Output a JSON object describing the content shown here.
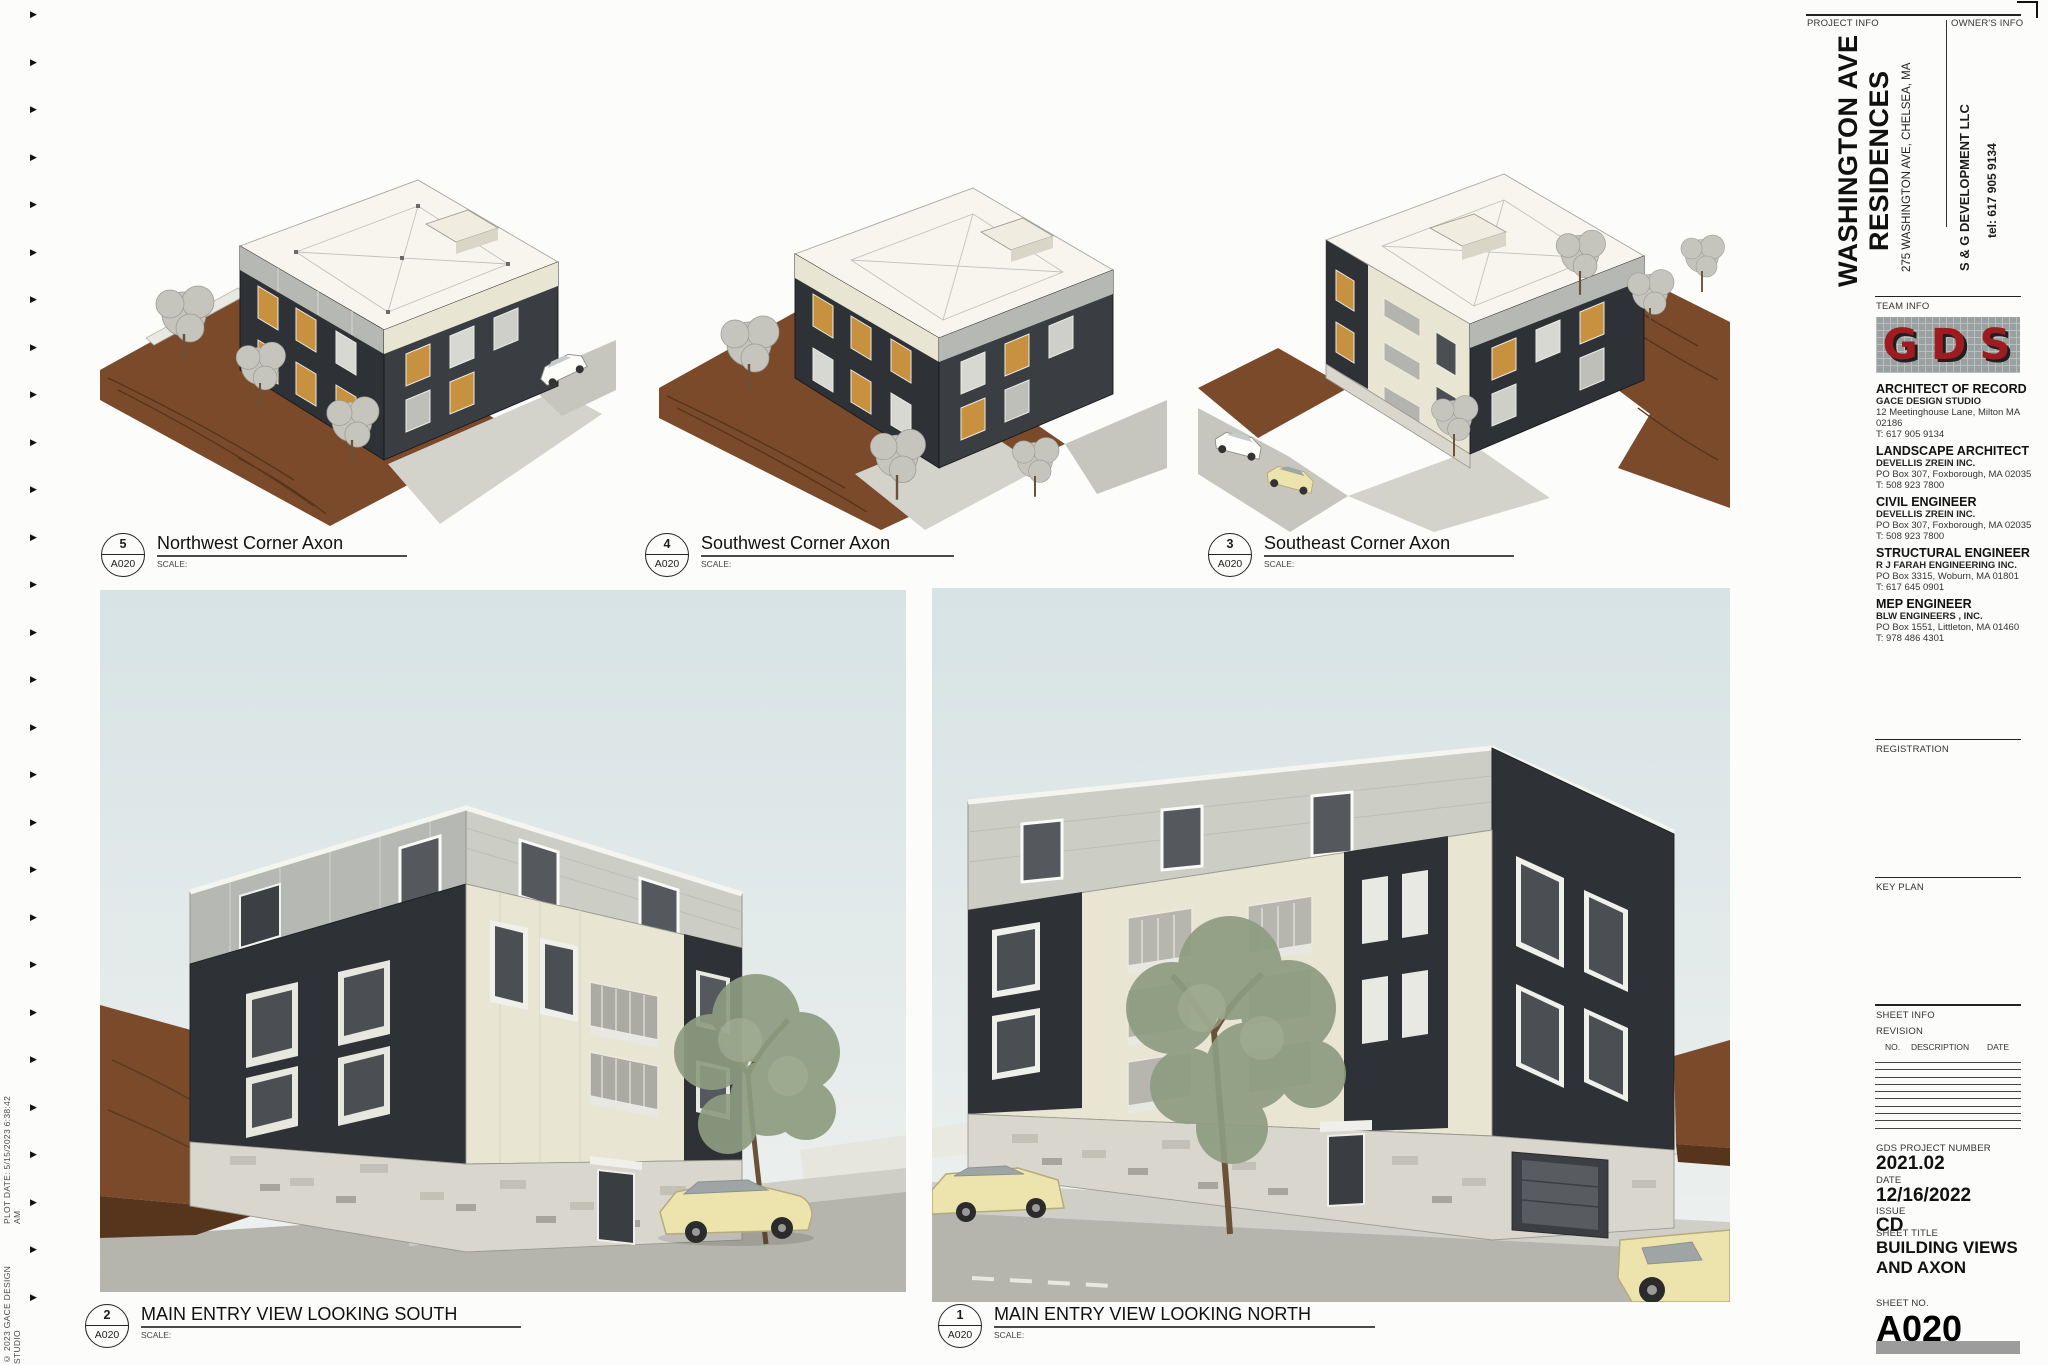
{
  "sheet_headers": {
    "project_info": "PROJECT INFO",
    "owners_info": "OWNER'S INFO",
    "team_info": "TEAM INFO",
    "registration": "REGISTRATION",
    "key_plan": "KEY PLAN",
    "sheet_info": "SHEET INFO",
    "revision": "REVISION",
    "rev_no": "NO.",
    "rev_description": "DESCRIPTION",
    "rev_date": "DATE"
  },
  "project": {
    "title_line1": "WASHINGTON AVE",
    "title_line2": "RESIDENCES",
    "address": "275 WASHINGTON AVE, CHELSEA, MA"
  },
  "owner": {
    "name": "S & G DEVELOPMENT LLC",
    "tel": "tel: 617 905 9134"
  },
  "logo": {
    "text": "GDS"
  },
  "team": [
    {
      "role": "ARCHITECT OF RECORD",
      "firm": "GACE DESIGN STUDIO",
      "address": "12 Meetinghouse Lane, Milton MA 02186",
      "tel": "T: 617 905 9134"
    },
    {
      "role": "LANDSCAPE ARCHITECT",
      "firm": "DEVELLIS ZREIN INC.",
      "address": "PO Box 307, Foxborough, MA 02035",
      "tel": "T: 508 923 7800"
    },
    {
      "role": "CIVIL ENGINEER",
      "firm": "DEVELLIS ZREIN INC.",
      "address": "PO Box 307, Foxborough, MA 02035",
      "tel": "T: 508 923 7800"
    },
    {
      "role": "STRUCTURAL ENGINEER",
      "firm": "R J FARAH ENGINEERING INC.",
      "address": "PO Box 3315, Woburn, MA 01801",
      "tel": "T: 617 645 0901"
    },
    {
      "role": "MEP ENGINEER",
      "firm": "BLW ENGINEERS , INC.",
      "address": "PO Box 1551, Littleton, MA 01460",
      "tel": "T: 978 486 4301"
    }
  ],
  "meta": {
    "project_number_label": "GDS PROJECT NUMBER",
    "project_number": "2021.02",
    "date_label": "DATE",
    "date": "12/16/2022",
    "issue_label": "ISSUE",
    "issue": "CD",
    "sheet_title_label": "SHEET TITLE",
    "sheet_title": "BUILDING VIEWS AND AXON",
    "sheet_no_label": "SHEET NO.",
    "sheet_no": "A020"
  },
  "edge": {
    "copyright": "© 2023 GACE DESIGN STUDIO",
    "plot_date": "PLOT DATE: 5/15/2023 6:38:42 AM"
  },
  "views": [
    {
      "num": "5",
      "ref": "A020",
      "title": "Northwest Corner Axon",
      "scale_label": "SCALE:"
    },
    {
      "num": "4",
      "ref": "A020",
      "title": "Southwest Corner Axon",
      "scale_label": "SCALE:"
    },
    {
      "num": "3",
      "ref": "A020",
      "title": "Southeast Corner Axon",
      "scale_label": "SCALE:"
    },
    {
      "num": "2",
      "ref": "A020",
      "title": "MAIN ENTRY VIEW LOOKING SOUTH",
      "scale_label": "SCALE:"
    },
    {
      "num": "1",
      "ref": "A020",
      "title": "MAIN ENTRY VIEW LOOKING NORTH",
      "scale_label": "SCALE:"
    }
  ],
  "colors": {
    "accent": "#9e1b20",
    "charcoal": "#2e3136",
    "cream": "#e9e5d3",
    "silver": "#b6b9b3",
    "shingle": "#cccec6",
    "stone": "#d9d7cd",
    "dirt": "#7a4a2a",
    "dirt-dark": "#57341c",
    "sky-top": "#d7e3e5",
    "sky-bottom": "#eef1ef",
    "street": "#b5b5ae",
    "sidewalk": "#cfcfc8",
    "tree-green": "#8d9c80",
    "tree-gray": "#c5c5be",
    "amber": "#c8913f",
    "car-cream": "#ece3ad"
  }
}
